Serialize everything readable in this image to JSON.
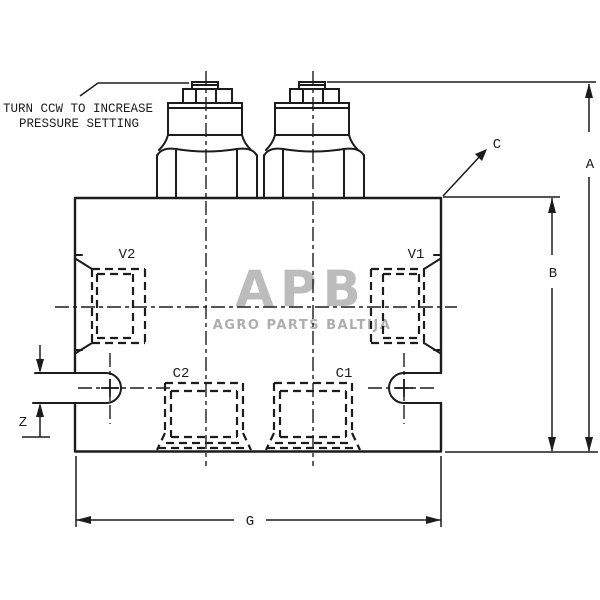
{
  "note": {
    "line1": "TURN CCW TO INCREASE",
    "line2": "PRESSURE SETTING"
  },
  "ports": {
    "v2": "V2",
    "v1": "V1",
    "c2": "C2",
    "c1": "C1"
  },
  "dimensions": {
    "a": "A",
    "b": "B",
    "c": "C",
    "g": "G",
    "z": "Z"
  },
  "watermark": {
    "logo": "APB",
    "subtitle": "AGRO PARTS BALTIJA"
  },
  "colors": {
    "line": "#1c1c1c",
    "background": "#ffffff",
    "watermark_logo": "#bcbcbc",
    "watermark_text": "#aeaeae"
  }
}
